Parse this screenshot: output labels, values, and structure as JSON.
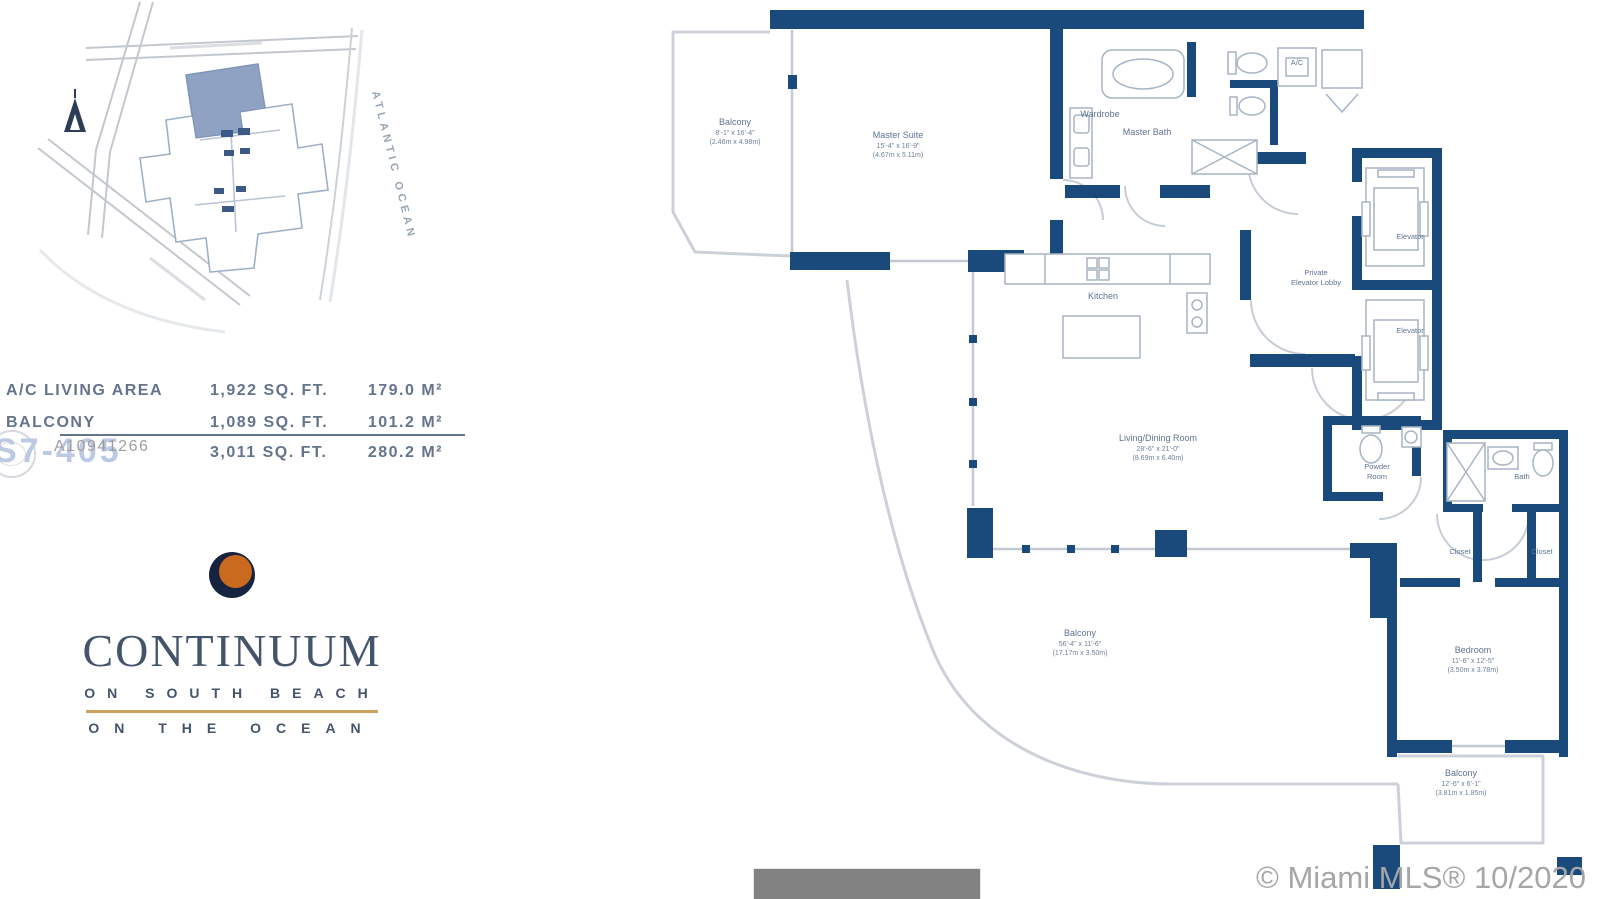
{
  "site_map": {
    "ocean_label": "ATLANTIC  OCEAN"
  },
  "area_table": {
    "rows": [
      {
        "label": "A/C LIVING AREA",
        "sqft": "1,922 SQ. FT.",
        "metric": "179.0 M²"
      },
      {
        "label": "BALCONY",
        "sqft": "1,089 SQ. FT.",
        "metric": "101.2 M²"
      },
      {
        "label": "",
        "sqft": "3,011 SQ. FT.",
        "metric": "280.2 M²"
      }
    ]
  },
  "watermarks": {
    "mls_id": "A10941266",
    "unit_number": "S7-405",
    "credit": "© Miami MLS® 10/2020"
  },
  "logo": {
    "name": "CONTINUUM",
    "tagline1": "ON SOUTH BEACH",
    "tagline2": "ON THE OCEAN"
  },
  "floor_plan": {
    "rooms": {
      "balcony_master": {
        "name": "Balcony",
        "dim_ft": "8'-1\" x 16'-4\"",
        "dim_m": "(2.46m x 4.98m)"
      },
      "master_suite": {
        "name": "Master Suite",
        "dim_ft": "15'-4\" x 16'-9\"",
        "dim_m": "(4.67m x 5.11m)"
      },
      "wardrobe": {
        "name": "Wardrobe"
      },
      "master_bath": {
        "name": "Master Bath"
      },
      "ac_closet": {
        "name": "A/C"
      },
      "kitchen": {
        "name": "Kitchen"
      },
      "living_dining": {
        "name": "Living/Dining Room",
        "dim_ft": "28'-6\" x 21'-0\"",
        "dim_m": "(8.69m x 6.40m)"
      },
      "private_lobby": {
        "line1": "Private",
        "line2": "Elevator Lobby"
      },
      "elevator_1": {
        "name": "Elevator"
      },
      "elevator_2": {
        "name": "Elevator"
      },
      "powder_room": {
        "line1": "Powder",
        "line2": "Room"
      },
      "bath": {
        "name": "Bath"
      },
      "closet_1": {
        "name": "Closet"
      },
      "closet_2": {
        "name": "Closet"
      },
      "bedroom": {
        "name": "Bedroom",
        "dim_ft": "11'-6\" x 12'-5\"",
        "dim_m": "(3.50m x 3.78m)"
      },
      "balcony_main": {
        "name": "Balcony",
        "dim_ft": "56'-4\" x 11'-6\"",
        "dim_m": "(17.17m x 3.50m)"
      },
      "balcony_bedroom": {
        "name": "Balcony",
        "dim_ft": "12'-6\" x 6'-1\"",
        "dim_m": "(3.81m x 1.85m)"
      }
    }
  },
  "colors": {
    "wall_navy": "#1a4a7c",
    "balcony_gray": "#ccd1d9",
    "label_blue": "#5f7390",
    "logo_navy": "#18233f",
    "logo_orange": "#c96a1e",
    "gold_rule": "#c8a35f"
  }
}
